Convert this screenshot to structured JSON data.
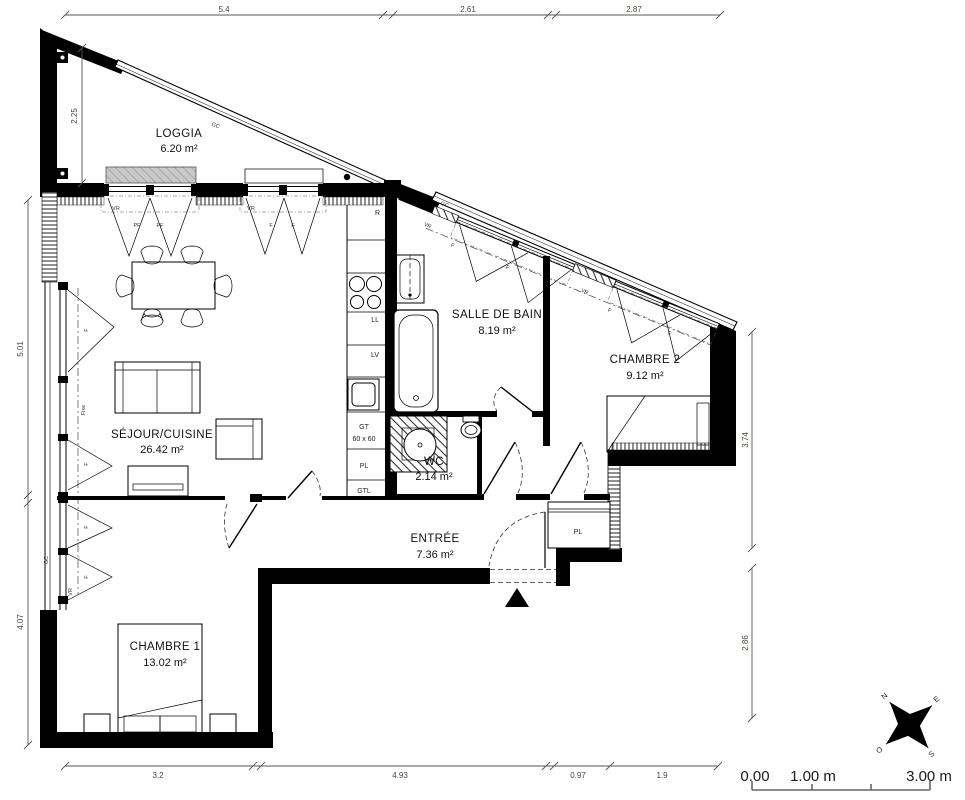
{
  "plan_title": "Plan d'appartement 3 pièces",
  "rooms": {
    "loggia": {
      "name": "LOGGIA",
      "area": "6.20 m²"
    },
    "sejour": {
      "name": "SÉJOUR/CUISINE",
      "area": "26.42 m²"
    },
    "sdb": {
      "name": "SALLE DE BAIN",
      "area": "8.19 m²"
    },
    "chambre2": {
      "name": "CHAMBRE 2",
      "area": "9.12 m²"
    },
    "wc": {
      "name": "WC",
      "area": "2.14 m²"
    },
    "entree": {
      "name": "ENTRÉE",
      "area": "7.36 m²"
    },
    "chambre1": {
      "name": "CHAMBRE 1",
      "area": "13.02 m²"
    }
  },
  "dimensions": {
    "top": [
      "5.4",
      "2.61",
      "2.87"
    ],
    "left": [
      "2.25",
      "5.01",
      "4.07"
    ],
    "right": [
      "3.74",
      "2.86"
    ],
    "bottom": [
      "3.2",
      "4.93",
      "0.97",
      "1.9"
    ]
  },
  "annotations": {
    "gc": "GC",
    "vr": "VR",
    "pf": "PF",
    "f": "F",
    "fixe": "Fixe",
    "r": "R",
    "ll": "LL",
    "lv": "LV",
    "gt": "GT",
    "gt_size": "60 x 60",
    "pl": "PL",
    "gtl": "GTL"
  },
  "scale_bar": {
    "start": "0.00",
    "mid": "1.00 m",
    "end": "3.00 m"
  },
  "compass": {
    "n": "N",
    "e": "E",
    "s": "S",
    "o": "O"
  },
  "colors": {
    "wall": "#000000",
    "dim_text": "#4a4437",
    "shutter_fill": "#c8c8c8"
  }
}
